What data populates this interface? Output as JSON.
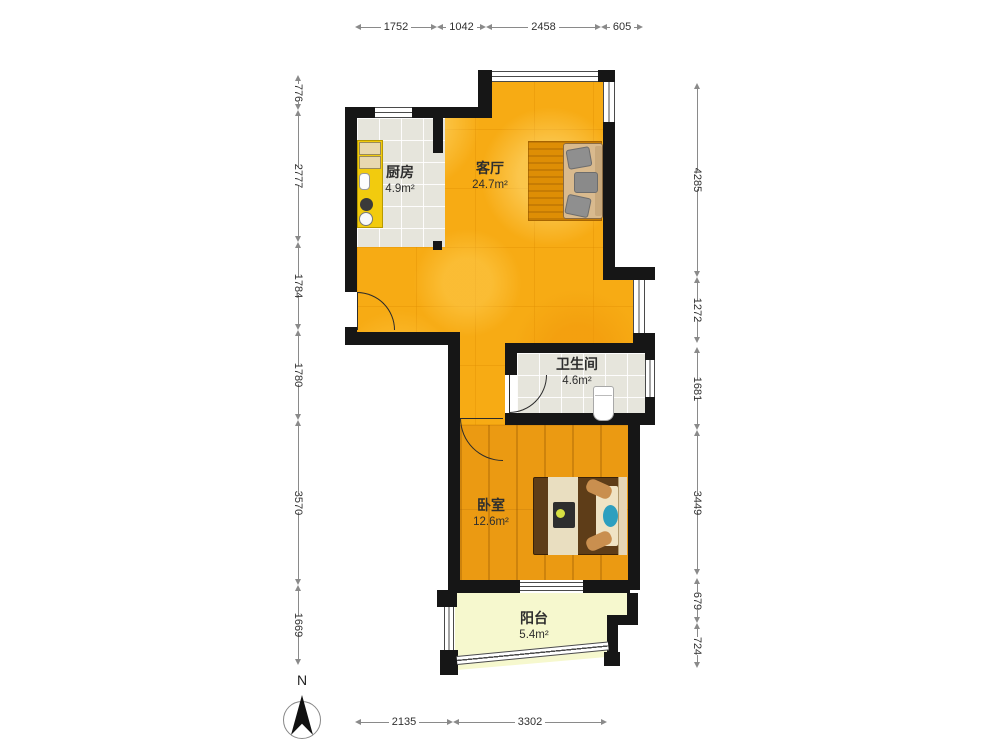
{
  "rooms": {
    "kitchen": {
      "name": "厨房",
      "area": "4.9m²"
    },
    "living": {
      "name": "客厅",
      "area": "24.7m²"
    },
    "bathroom": {
      "name": "卫生间",
      "area": "4.6m²"
    },
    "bedroom": {
      "name": "卧室",
      "area": "12.6m²"
    },
    "balcony": {
      "name": "阳台",
      "area": "5.4m²"
    }
  },
  "dims": {
    "top": [
      "1752",
      "1042",
      "2458",
      "605"
    ],
    "left": [
      "776",
      "2777",
      "1784",
      "1780",
      "3570",
      "1669"
    ],
    "right": [
      "4285",
      "1272",
      "1681",
      "3449",
      "679",
      "724"
    ],
    "bottom": [
      "2135",
      "3302"
    ]
  },
  "compass": {
    "label": "N"
  },
  "colors": {
    "wall": "#161616",
    "living_floor": "#f7ab14",
    "bedroom_floor": "#eb9a12",
    "balcony_floor": "#f6f8ce",
    "tile_floor": "#e6e5dc",
    "counter": "#f2cb0e",
    "sofa": "#d9ba8e",
    "bed": "#5e3d18",
    "accent_teal": "#2d9fbf"
  }
}
